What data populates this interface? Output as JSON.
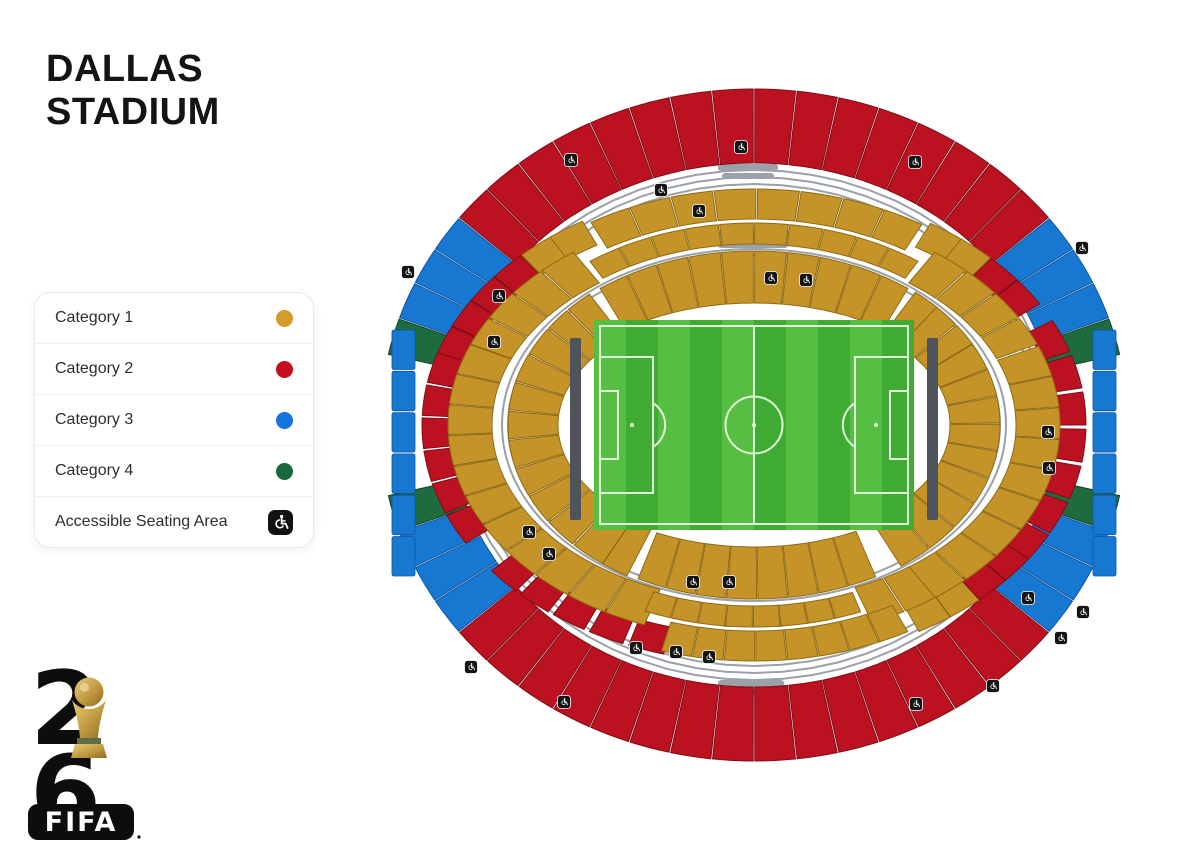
{
  "title": {
    "line1": "DALLAS",
    "line2": "STADIUM"
  },
  "legend": {
    "items": [
      {
        "label": "Category 1",
        "color": "#D69B2D",
        "type": "dot"
      },
      {
        "label": "Category 2",
        "color": "#C40D21",
        "type": "dot"
      },
      {
        "label": "Category 3",
        "color": "#1573E0",
        "type": "dot"
      },
      {
        "label": "Category 4",
        "color": "#1A693D",
        "type": "dot"
      },
      {
        "label": "Accessible Seating Area",
        "type": "wheelchair"
      }
    ]
  },
  "logo": {
    "digit_top": "2",
    "digit_bottom": "6",
    "wordmark": "FIFA"
  },
  "stadium": {
    "colors": {
      "category1": "#C59428",
      "category2": "#BB1120",
      "category3": "#1778D2",
      "category4": "#1E6B40",
      "rail": "#9AA1A8",
      "bench": "#4E545A",
      "pitch_light": "#56BE43",
      "pitch_dark": "#3FAB33",
      "pitch_line": "#DFF8D8"
    },
    "sections": {
      "ring400_top": [
        [
          "401",
          4
        ],
        [
          "402",
          3
        ],
        [
          "403",
          3
        ],
        [
          "404",
          3
        ],
        [
          "405",
          2
        ],
        [
          "406",
          2
        ],
        [
          "407",
          2
        ],
        [
          "408",
          2
        ],
        [
          "409",
          2
        ],
        [
          "410",
          2
        ],
        [
          "411",
          2
        ],
        [
          "412",
          2
        ],
        [
          "413",
          2
        ],
        [
          "414",
          2
        ],
        [
          "415",
          2
        ],
        [
          "416",
          2
        ],
        [
          "417",
          2
        ],
        [
          "418",
          2
        ],
        [
          "419",
          2
        ],
        [
          "420",
          2
        ],
        [
          "421",
          3
        ],
        [
          "422",
          3
        ],
        [
          "423",
          3
        ],
        [
          "424",
          4
        ]
      ],
      "ring400_bottom": [
        [
          "454",
          4
        ],
        [
          "453",
          3
        ],
        [
          "452",
          3
        ],
        [
          "451",
          3
        ],
        [
          "450",
          2
        ],
        [
          "449",
          2
        ],
        [
          "448",
          2
        ],
        [
          "447",
          2
        ],
        [
          "446",
          2
        ],
        [
          "445",
          2
        ],
        [
          "444",
          2
        ],
        [
          "443",
          2
        ],
        [
          "442",
          2
        ],
        [
          "441",
          2
        ],
        [
          "440",
          2
        ],
        [
          "439",
          2
        ],
        [
          "438",
          2
        ],
        [
          "437",
          2
        ],
        [
          "436",
          2
        ],
        [
          "435",
          2
        ],
        [
          "434",
          3
        ],
        [
          "433",
          3
        ],
        [
          "432",
          3
        ],
        [
          "431",
          4
        ]
      ],
      "sidebar_left": [
        [
          "460",
          3
        ],
        [
          "459",
          3
        ],
        [
          "458",
          3
        ],
        [
          "457",
          3
        ],
        [
          "456",
          3
        ],
        [
          "455",
          3
        ]
      ],
      "sidebar_right": [
        [
          "425",
          3
        ],
        [
          "426",
          3
        ],
        [
          "427",
          3
        ],
        [
          "428",
          3
        ],
        [
          "429",
          3
        ],
        [
          "430",
          3
        ]
      ],
      "ring300_top": [
        [
          "301",
          2
        ],
        [
          "302",
          2
        ],
        [
          "303",
          2
        ],
        [
          "304",
          2
        ],
        [
          "305",
          1
        ],
        [
          "306",
          1
        ],
        [
          "316",
          1
        ],
        [
          "317",
          1
        ],
        [
          "318",
          2
        ],
        [
          "319",
          2
        ]
      ],
      "ring300_left": [
        [
          "350",
          2
        ],
        [
          "349",
          2
        ],
        [
          "348",
          2
        ],
        [
          "347",
          2
        ],
        [
          "346",
          2
        ],
        [
          "345",
          2
        ]
      ],
      "ring300_right": [
        [
          "320",
          2
        ],
        [
          "321",
          2
        ],
        [
          "322",
          2
        ],
        [
          "323",
          2
        ],
        [
          "324",
          2
        ],
        [
          "325",
          2
        ],
        [
          "326",
          2
        ]
      ],
      "ring300_bottom": [
        [
          "344",
          2
        ],
        [
          "343",
          2
        ],
        [
          "342",
          2
        ],
        [
          "341",
          2
        ],
        [
          "340",
          2
        ],
        [
          "330",
          1
        ],
        [
          "329",
          1
        ],
        [
          "328",
          2
        ],
        [
          "327",
          2
        ]
      ],
      "ring200_top": [
        [
          "201",
          1
        ],
        [
          "202",
          1
        ],
        [
          "203",
          1
        ],
        [
          "204",
          1
        ],
        [
          "216",
          1
        ],
        [
          "217",
          1
        ],
        [
          "218",
          1
        ],
        [
          "219",
          1
        ]
      ],
      "ring200_left": [
        [
          "250",
          1
        ],
        [
          "249",
          1
        ],
        [
          "248",
          1
        ],
        [
          "247",
          1
        ],
        [
          "246",
          1
        ],
        [
          "245",
          1
        ],
        [
          "244",
          1
        ],
        [
          "243",
          1
        ],
        [
          "242",
          1
        ],
        [
          "241",
          1
        ],
        [
          "240",
          1
        ]
      ],
      "ring200_right": [
        [
          "220",
          1
        ],
        [
          "221",
          1
        ],
        [
          "222",
          1
        ],
        [
          "223",
          1
        ],
        [
          "224",
          1
        ],
        [
          "225",
          1
        ],
        [
          "226",
          1
        ],
        [
          "227",
          1
        ],
        [
          "228",
          1
        ]
      ],
      "ring200_bottom": [
        [
          "230",
          1
        ],
        [
          "229",
          1
        ]
      ],
      "club300_top": [
        "C307",
        "C308",
        "C309",
        "C310",
        "C311",
        "C312",
        "C313",
        "C314"
      ],
      "club200_top": [
        "C205",
        "C206",
        "C207",
        "C208",
        "C209",
        "C210",
        "C211",
        "C212",
        "C213",
        "C214"
      ],
      "club100_top": [
        "C106",
        "C107",
        "C108",
        "C109",
        "C110",
        "C111",
        "C112",
        "C113",
        "C114",
        "C115"
      ],
      "club100_bottom": [
        "C139",
        "C138",
        "C137",
        "C136",
        "C135",
        "C134",
        "C133",
        "C132"
      ],
      "club200_bottom": [
        "C239",
        "C238",
        "C237",
        "C236",
        "C235",
        "C234",
        "C233",
        "C232"
      ],
      "club300_bottom": [
        "C339",
        "C338",
        "C337",
        "C336",
        "C335",
        "C334",
        "C333",
        "C332"
      ],
      "ring100_top": [
        [
          "102",
          1
        ],
        [
          "103",
          1
        ],
        [
          "118",
          1
        ],
        [
          "119",
          1
        ],
        [
          "120",
          1
        ]
      ],
      "ring100_left": [
        [
          "101",
          1
        ],
        [
          "150",
          1
        ],
        [
          "149",
          1
        ],
        [
          "148",
          1
        ],
        [
          "147",
          1
        ],
        [
          "146",
          1
        ],
        [
          "145",
          1
        ],
        [
          "144",
          1
        ],
        [
          "143",
          1
        ]
      ],
      "ring100_right": [
        [
          "121",
          1
        ],
        [
          "122",
          1
        ],
        [
          "123",
          1
        ],
        [
          "124",
          1
        ],
        [
          "125",
          1
        ],
        [
          "126",
          1
        ],
        [
          "127",
          1
        ],
        [
          "128",
          1
        ],
        [
          "129",
          1
        ]
      ],
      "ring100_bottom": [
        [
          "142",
          1
        ]
      ]
    }
  }
}
